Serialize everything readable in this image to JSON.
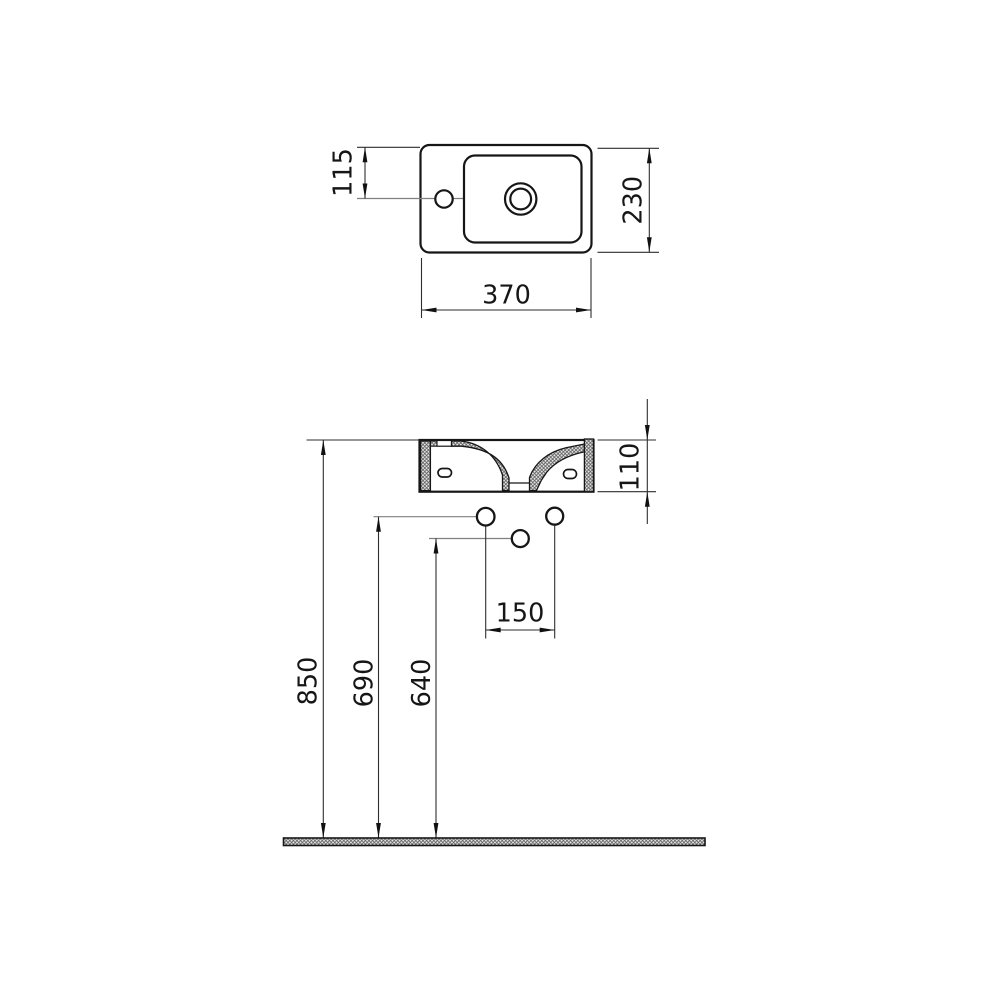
{
  "drawing": {
    "type": "technical-dimension-drawing",
    "subject": "wall-hung washbasin, plan view and front section with installation heights",
    "background_color": "#ffffff",
    "outline_color": "#161616",
    "dimension_line_color": "#2e2e2e",
    "leader_line_color": "#808080",
    "hatch_color": "#5a5a5a",
    "dims": {
      "basin_width": "370",
      "basin_depth": "230",
      "tap_center_offset": "115",
      "basin_height": "110",
      "fixing_hole_spacing": "150",
      "rim_height_from_floor": "850",
      "upper_fixing_holes_height": "690",
      "lower_fixing_hole_height": "640"
    }
  }
}
